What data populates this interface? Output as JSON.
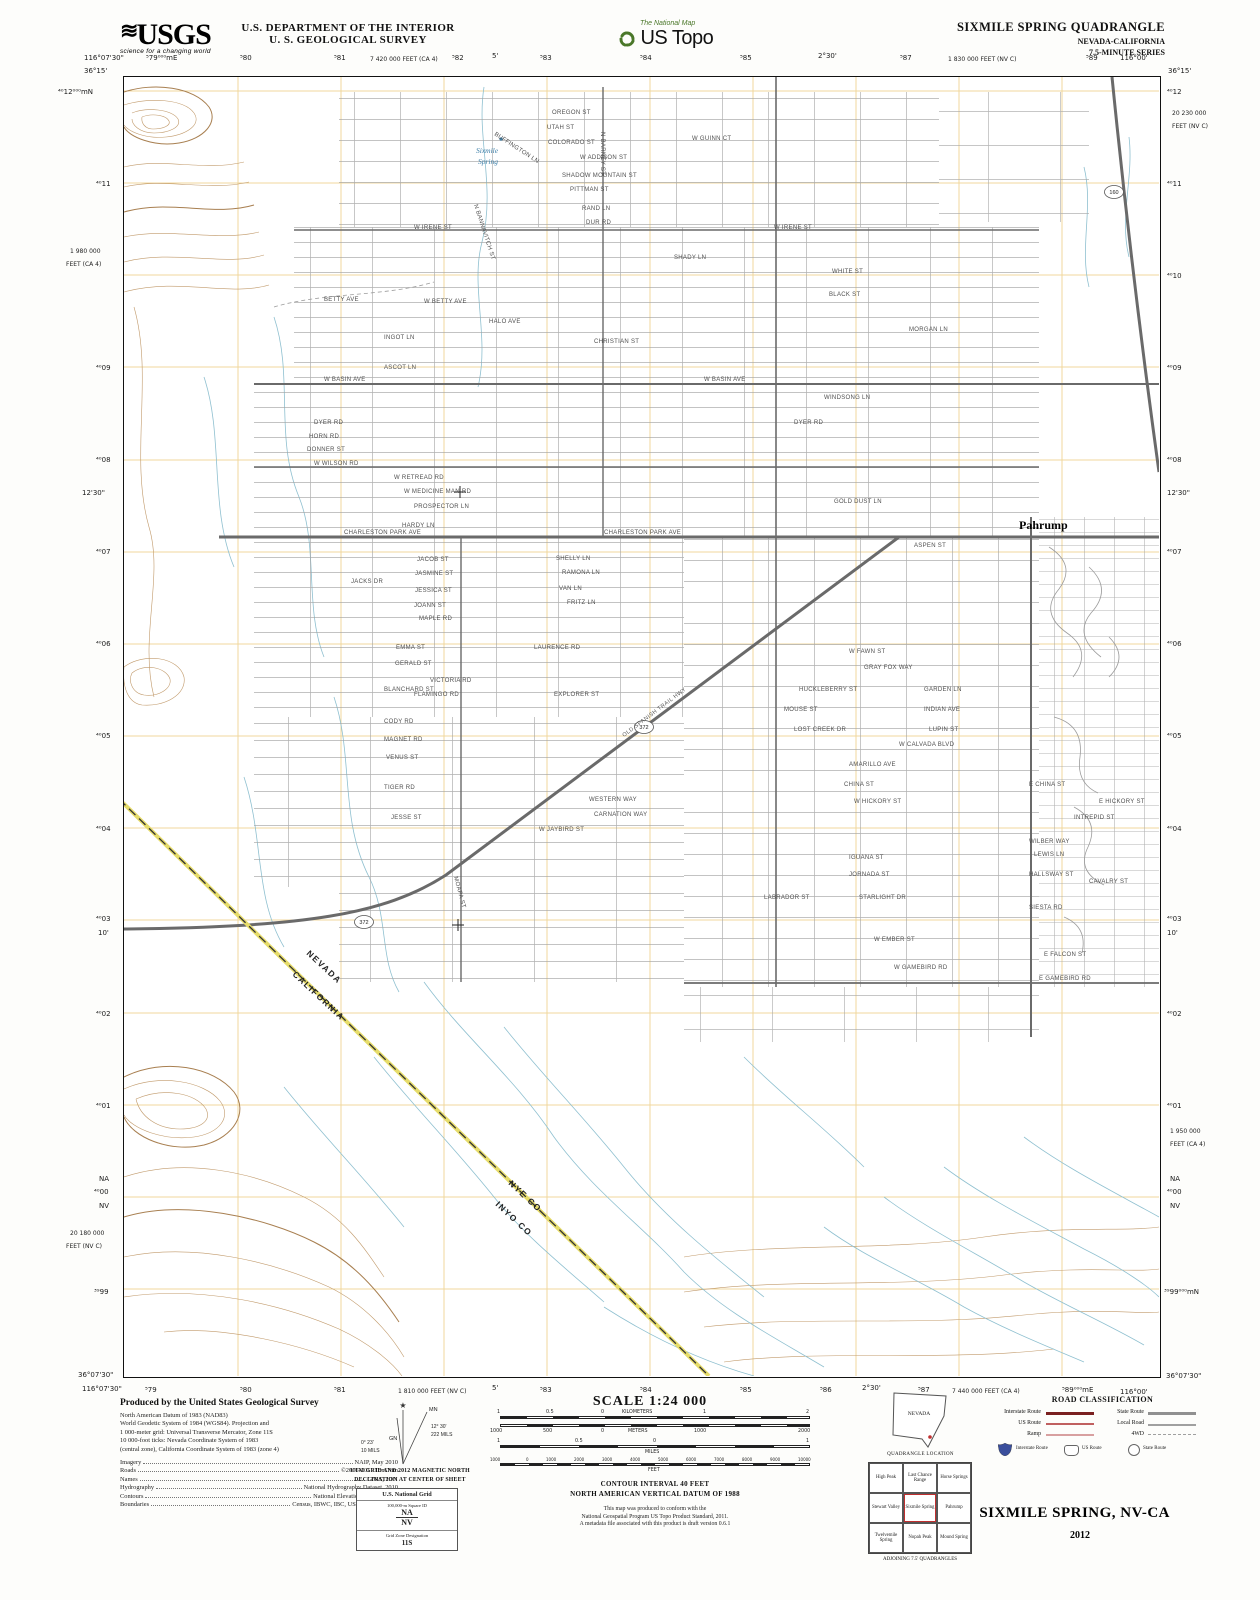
{
  "header": {
    "usgs_wave": "≋",
    "usgs_logo": "USGS",
    "usgs_tagline": "science for a changing world",
    "dept_line1": "U.S. DEPARTMENT OF THE INTERIOR",
    "dept_line2": "U. S. GEOLOGICAL SURVEY",
    "ustopo_small": "The National Map",
    "ustopo_large": "US Topo",
    "quad_title": "SIXMILE SPRING QUADRANGLE",
    "quad_state": "NEVADA-CALIFORNIA",
    "quad_series": "7.5-MINUTE SERIES"
  },
  "margins": {
    "top": [
      "116°07'30\"",
      "36°15'",
      "⁵79⁰⁰⁰mE",
      "⁵80",
      "⁵81",
      "7 420 000 FEET (CA 4)",
      "⁵82",
      "5'",
      "⁵83",
      "⁵84",
      "⁵85",
      "2°30'",
      "⁵87",
      "1 830 000 FEET (NV C)",
      "⁵89",
      "116°00'",
      "36°15'"
    ],
    "bottom": [
      "36°07'30\"",
      "116°07'30\"",
      "⁵79",
      "⁵80",
      "⁵81",
      "1 810 000 FEET (NV C)",
      "5'",
      "⁵83",
      "⁵84",
      "⁵85",
      "⁵86",
      "2°30'",
      "⁵87",
      "7 440 000 FEET (CA 4)",
      "⁵89⁰⁰⁰mE",
      "116°00'",
      "36°07'30\""
    ],
    "left": [
      "⁴⁰12⁰⁰⁰mN",
      "⁴⁰11",
      "1 980 000",
      "FEET (CA 4)",
      "⁴⁰09",
      "⁴⁰08",
      "12'30\"",
      "⁴⁰07",
      "⁴⁰06",
      "⁴⁰05",
      "⁴⁰04",
      "⁴⁰03",
      "10'",
      "⁴⁰02",
      "⁴⁰01",
      "NA",
      "⁴⁰00",
      "NV",
      "20 180 000",
      "FEET (NV C)",
      "³⁹99"
    ],
    "right": [
      "⁴⁰12",
      "20 230 000",
      "FEET (NV C)",
      "⁴⁰11",
      "⁴⁰10",
      "⁴⁰09",
      "⁴⁰08",
      "12'30\"",
      "⁴⁰07",
      "⁴⁰06",
      "⁴⁰05",
      "⁴⁰04",
      "⁴⁰03",
      "10'",
      "⁴⁰02",
      "⁴⁰01",
      "1 950 000",
      "FEET (CA 4)",
      "NA",
      "⁴⁰00",
      "NV",
      "³⁹99⁰⁰⁰mN"
    ]
  },
  "map": {
    "town": "Pahrump",
    "spring_line1": "Sixmile",
    "spring_line2": "Spring",
    "state_top": "NEVADA",
    "state_bottom": "CALIFORNIA",
    "county_top": "NYE CO",
    "county_bottom": "INYO CO",
    "highway": "OLD SPANISH TRAIL HWY",
    "shield_160": "160",
    "shield_372": "372",
    "streets": [
      "OREGON ST",
      "UTAH ST",
      "COLORADO ST",
      "W ADDISON ST",
      "SHADOW MOUNTAIN ST",
      "PITTMAN ST",
      "RAND LN",
      "DUR RD",
      "BUFFINGTON LN",
      "N BANNAVITCH ST",
      "N BARNEY ST",
      "W GUINN CT",
      "W IRENE ST",
      "W IRENE ST",
      "SHADY LN",
      "WHITE ST",
      "BLACK ST",
      "BETTY AVE",
      "W BETTY AVE",
      "MORGAN LN",
      "HALO AVE",
      "CHRISTIAN ST",
      "INGOT LN",
      "ASCOT LN",
      "W BASIN AVE",
      "W BASIN AVE",
      "WINDSONG LN",
      "DYER RD",
      "DYER RD",
      "HORN RD",
      "DONNER ST",
      "W WILSON RD",
      "W RETREAD RD",
      "W MEDICINE MAN RD",
      "PROSPECTOR LN",
      "GOLD DUST LN",
      "HARDY LN",
      "CHARLESTON PARK AVE",
      "CHARLESTON PARK AVE",
      "ASPEN ST",
      "JACOB ST",
      "JASMINE ST",
      "JESSICA ST",
      "JOANN ST",
      "MAPLE RD",
      "SHELLY LN",
      "RAMONA LN",
      "VAN LN",
      "FRITZ LN",
      "JACKS DR",
      "EMMA ST",
      "GERALD ST",
      "VICTORIA RD",
      "FLAMINGO RD",
      "LAURENCE RD",
      "BLANCHARD ST",
      "CODY RD",
      "MAGNET RD",
      "VENUS ST",
      "TIGER RD",
      "EXPLORER ST",
      "W FAWN ST",
      "GRAY FOX WAY",
      "HUCKLEBERRY ST",
      "GARDEN LN",
      "MOUSE ST",
      "INDIAN AVE",
      "LOST CREEK DR",
      "LUPIN ST",
      "W CALVADA BLVD",
      "AMARILLO AVE",
      "CHINA ST",
      "E CHINA ST",
      "WESTERN WAY",
      "W HICKORY ST",
      "E HICKORY ST",
      "CARNATION WAY",
      "INTREPID ST",
      "W JAYBIRD ST",
      "WILBER WAY",
      "LEWIS LN",
      "IGUANA ST",
      "JORNADA ST",
      "HALLSWAY ST",
      "CAVALRY ST",
      "LABRADOR ST",
      "STARLIGHT DR",
      "SIESTA RD",
      "W EMBER ST",
      "E FALCON ST",
      "W GAMEBIRD RD",
      "E GAMEBIRD RD",
      "MOAPA ST",
      "JESSE ST"
    ]
  },
  "footer": {
    "produced_by": "Produced by the United States Geological Survey",
    "datum_lines": [
      "North American Datum of 1983 (NAD83)",
      "World Geodetic System of 1984 (WGS84).  Projection and",
      "1 000-meter grid: Universal Transverse Mercator, Zone 11S",
      "10 000-foot ticks: Nevada Coordinate System of 1983",
      "(central zone), California Coordinate System of 1983 (zone 4)"
    ],
    "credits": [
      {
        "label": "Imagery",
        "value": "NAIP, May 2010"
      },
      {
        "label": "Roads",
        "value": "©2006-2011 TomTom"
      },
      {
        "label": "Names",
        "value": "GNIS, 2011"
      },
      {
        "label": "Hydrography",
        "value": "National Hydrography Dataset, 2010"
      },
      {
        "label": "Contours",
        "value": "National Elevation Dataset, 2001"
      },
      {
        "label": "Boundaries",
        "value": "Census, IBWC, IBC, USGS, 1972 - 2010"
      }
    ],
    "declination": {
      "star": "★",
      "mn": "MN",
      "gn": "GN",
      "mn_deg": "12° 30'",
      "mn_mils": "222 MILS",
      "gn_deg": "0° 23'",
      "gn_mils": "10 MILS",
      "caption1": "UTM GRID AND 2012 MAGNETIC NORTH",
      "caption2": "DECLINATION AT CENTER OF SHEET"
    },
    "usng": {
      "title": "U.S. National Grid",
      "sq_label": "100,000-m Square ID",
      "sq1": "NA",
      "sq2": "NV",
      "gzd_label": "Grid Zone Designation",
      "gzd": "11S"
    },
    "scale": {
      "title": "SCALE 1:24 000",
      "km_ticks": [
        "1",
        "0.5",
        "0",
        "1",
        "2"
      ],
      "km_unit": "KILOMETERS",
      "m_ticks": [
        "1000",
        "500",
        "0",
        "1000",
        "2000"
      ],
      "m_unit": "METERS",
      "mi_ticks": [
        "1",
        "0.5",
        "0",
        "1"
      ],
      "mi_unit": "MILES",
      "ft_ticks": [
        "1000",
        "0",
        "1000",
        "2000",
        "3000",
        "4000",
        "5000",
        "6000",
        "7000",
        "8000",
        "9000",
        "10000"
      ],
      "ft_unit": "FEET"
    },
    "contour1": "CONTOUR INTERVAL 40 FEET",
    "contour2": "NORTH AMERICAN VERTICAL DATUM OF 1988",
    "conformance": [
      "This map was produced to conform with the",
      "National Geospatial Program US Topo Product Standard, 2011.",
      "A metadata file associated with this product is draft version 0.6.1"
    ],
    "quad_location": {
      "state": "NEVADA",
      "caption": "QUADRANGLE LOCATION"
    },
    "adjoining": {
      "cells": [
        "High Peak",
        "Last Chance Range",
        "Horse Springs",
        "Stewart Valley",
        "Sixmile Spring",
        "Pahrump",
        "Twelvemile Spring",
        "Nopah Peak",
        "Mound Spring"
      ],
      "caption": "ADJOINING 7.5' QUADRANGLES"
    },
    "road_class": {
      "title": "ROAD CLASSIFICATION",
      "left_labels": [
        "Interstate Route",
        "US Route",
        "Ramp"
      ],
      "right_labels": [
        "State Route",
        "Local Road",
        "4WD"
      ],
      "shield_labels": [
        "Interstate Route",
        "US Route",
        "State Route"
      ]
    },
    "sheet_title": "SIXMILE SPRING, NV-CA",
    "year": "2012"
  },
  "colors": {
    "accent_green": "#4a7729",
    "contour_brown": "#c19a6b",
    "stream_blue": "#8fc0d0",
    "grid_yellow": "#f0d79c",
    "road_gray": "#6a6a6a",
    "state_line_yellow": "#e6dc6a",
    "legend_red": "#7a2020"
  }
}
